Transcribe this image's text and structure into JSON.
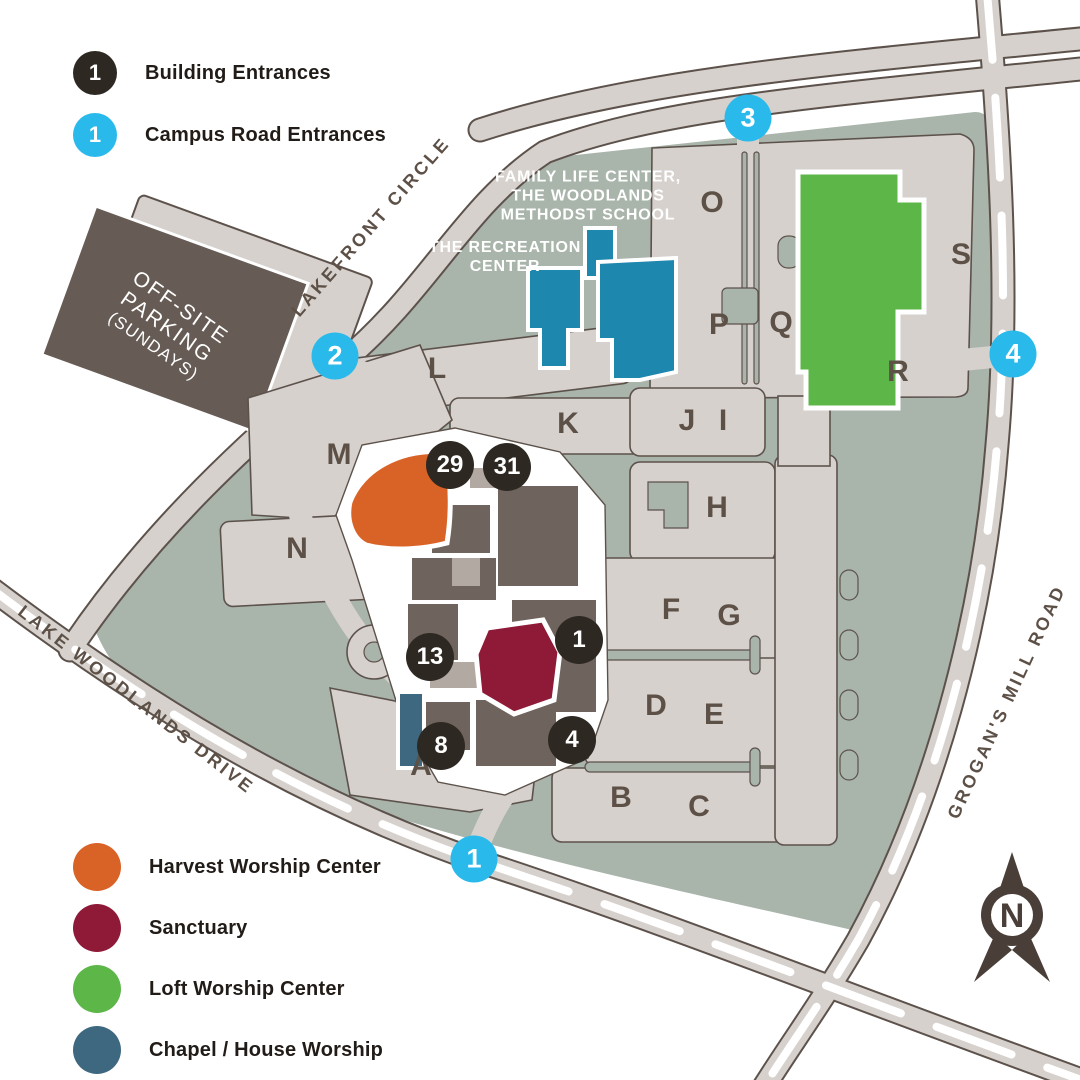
{
  "legend_top": {
    "items": [
      {
        "number": "1",
        "label": "Building Entrances",
        "color": "#2e2823",
        "icon": "building-entrance-badge"
      },
      {
        "number": "1",
        "label": "Campus Road Entrances",
        "color": "#29b9ea",
        "icon": "road-entrance-badge"
      }
    ]
  },
  "legend_bottom": {
    "items": [
      {
        "label": "Harvest Worship Center",
        "color": "#d96226"
      },
      {
        "label": "Sanctuary",
        "color": "#8e1a38"
      },
      {
        "label": "Loft Worship Center",
        "color": "#5cb648"
      },
      {
        "label": "Chapel / House Worship",
        "color": "#3d6880"
      }
    ]
  },
  "map": {
    "area_labels": [
      {
        "id": "family-life-center-label",
        "lines": [
          "FAMILY LIFE CENTER,",
          "THE WOODLANDS",
          "METHODST SCHOOL"
        ],
        "x": 588,
        "y": 196
      },
      {
        "id": "recreation-center-label",
        "lines": [
          "THE RECREATION",
          "CENTER"
        ],
        "x": 505,
        "y": 257
      }
    ],
    "road_labels": [
      {
        "id": "lakefront-circle-label",
        "text": "LAKEFRONT CIRCLE",
        "x": 371,
        "y": 227,
        "angle": -49
      },
      {
        "id": "lake-woodlands-drive-label",
        "text": "LAKE WOODLANDS DRIVE",
        "x": 136,
        "y": 700,
        "angle": 38
      },
      {
        "id": "grogans-mill-road-label",
        "text": "GROGAN'S MILL ROAD",
        "x": 1007,
        "y": 702,
        "angle": -65
      }
    ],
    "offsite_parking": {
      "lines": [
        "OFF-SITE",
        "PARKING",
        "(SUNDAYS)"
      ]
    },
    "lot_letters": [
      {
        "t": "A",
        "x": 421,
        "y": 766
      },
      {
        "t": "B",
        "x": 621,
        "y": 798
      },
      {
        "t": "C",
        "x": 699,
        "y": 807
      },
      {
        "t": "D",
        "x": 656,
        "y": 706
      },
      {
        "t": "E",
        "x": 714,
        "y": 715
      },
      {
        "t": "F",
        "x": 671,
        "y": 610
      },
      {
        "t": "G",
        "x": 729,
        "y": 616
      },
      {
        "t": "H",
        "x": 717,
        "y": 508
      },
      {
        "t": "I",
        "x": 723,
        "y": 421
      },
      {
        "t": "J",
        "x": 687,
        "y": 421
      },
      {
        "t": "K",
        "x": 568,
        "y": 424
      },
      {
        "t": "L",
        "x": 437,
        "y": 369
      },
      {
        "t": "M",
        "x": 339,
        "y": 455
      },
      {
        "t": "N",
        "x": 297,
        "y": 549
      },
      {
        "t": "O",
        "x": 712,
        "y": 203
      },
      {
        "t": "P",
        "x": 719,
        "y": 325
      },
      {
        "t": "Q",
        "x": 781,
        "y": 323
      },
      {
        "t": "R",
        "x": 898,
        "y": 372
      },
      {
        "t": "S",
        "x": 961,
        "y": 255
      }
    ],
    "building_entrances": [
      {
        "n": "29",
        "x": 450,
        "y": 465
      },
      {
        "n": "31",
        "x": 507,
        "y": 467
      },
      {
        "n": "1",
        "x": 579,
        "y": 640
      },
      {
        "n": "13",
        "x": 430,
        "y": 657
      },
      {
        "n": "8",
        "x": 441,
        "y": 746
      },
      {
        "n": "4",
        "x": 572,
        "y": 740
      }
    ],
    "road_entrances": [
      {
        "n": "1",
        "x": 474,
        "y": 859
      },
      {
        "n": "2",
        "x": 335,
        "y": 356
      },
      {
        "n": "3",
        "x": 748,
        "y": 118
      },
      {
        "n": "4",
        "x": 1013,
        "y": 354
      }
    ],
    "compass": {
      "label": "N"
    }
  },
  "colors": {
    "campus_green": "#a9b4ab",
    "road_fill": "#d6d1cd",
    "road_outline": "#5d524b",
    "building_dark": "#6e635d",
    "building_light": "#b2a9a3",
    "offsite_parking": "#675c55",
    "harvest_orange": "#d96226",
    "sanctuary_maroon": "#8e1a38",
    "loft_green": "#5cb648",
    "chapel_blue": "#3d6880",
    "school_teal": "#1d87ae",
    "entrance_dark": "#2e2823",
    "entrance_cyan": "#29b9ea",
    "label_brown": "#5d5047"
  }
}
